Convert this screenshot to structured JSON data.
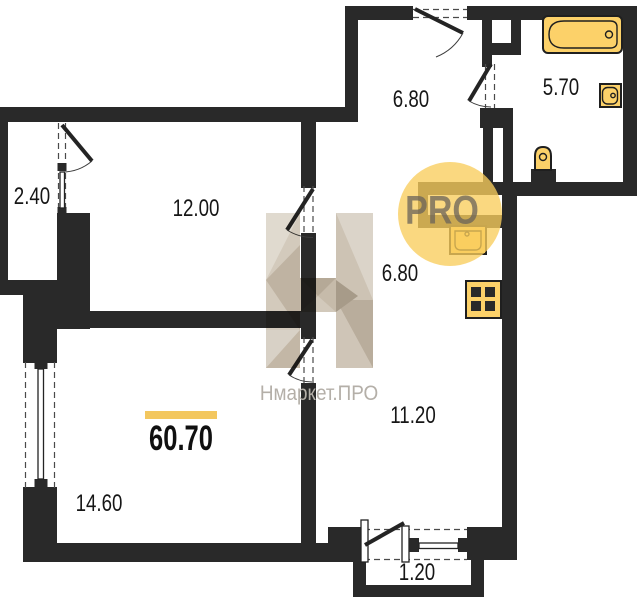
{
  "plan": {
    "total_area": "60.70",
    "rooms": [
      {
        "name": "balcony-left",
        "area": "2.40"
      },
      {
        "name": "bedroom",
        "area": "12.00"
      },
      {
        "name": "hallway",
        "area": "6.80"
      },
      {
        "name": "bathroom",
        "area": "5.70"
      },
      {
        "name": "corridor",
        "area": "6.80"
      },
      {
        "name": "kitchen-living",
        "area": "11.20"
      },
      {
        "name": "living-room",
        "area": "14.60"
      },
      {
        "name": "balcony-bottom",
        "area": "1.20"
      }
    ],
    "fixtures": [
      "bathtub",
      "bathroom-sink",
      "toilet",
      "kitchen-sink",
      "stove"
    ]
  },
  "watermark": {
    "brand": "Нмаркет.ПРО",
    "badge": "PRO"
  },
  "colors": {
    "wall": "#292929",
    "fixture": "#fcd169",
    "accent_bar": "#f3c75f",
    "badge_circle": "#f8cd5c",
    "watermark_text": "#b4afa8"
  }
}
